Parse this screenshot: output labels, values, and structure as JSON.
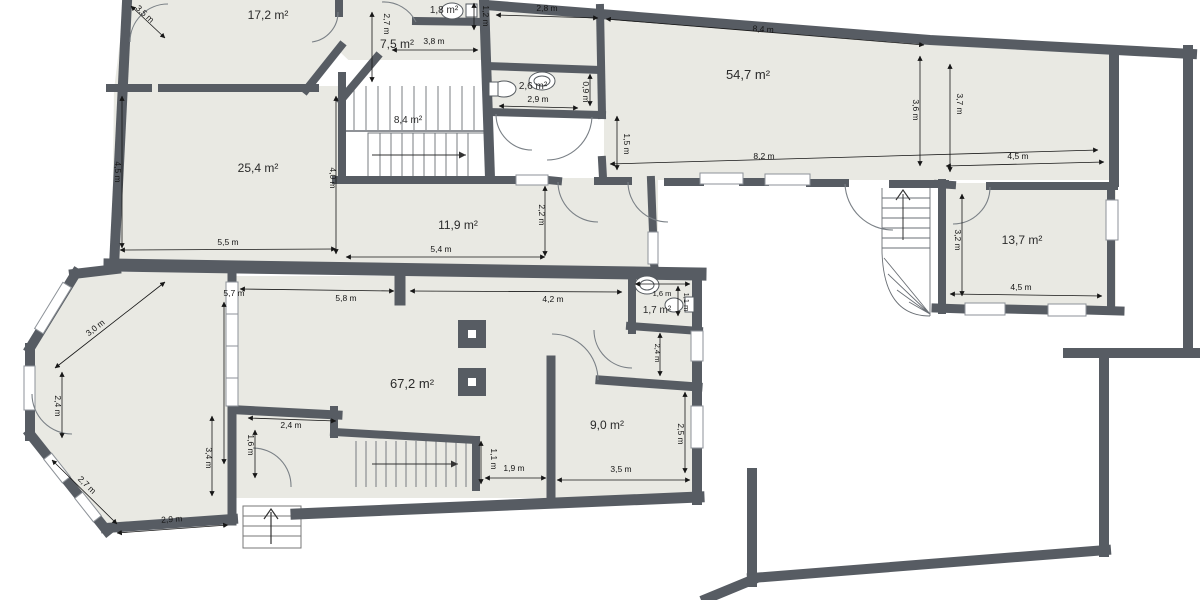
{
  "floorplan": {
    "colors": {
      "wall": "#575c63",
      "room_fill": "#e9e9e3",
      "background": "#ffffff",
      "dim": "#1a1a1a",
      "door": "#7a8086",
      "stair": "#6a6f75"
    },
    "rooms": {
      "r172": "17,2 m²",
      "r18": "1,8 m²",
      "r75": "7,5 m²",
      "r26": "2,6 m²",
      "r547": "54,7 m²",
      "r84": "8,4 m²",
      "r254": "25,4 m²",
      "r119": "11,9 m²",
      "r137": "13,7 m²",
      "r672": "67,2 m²",
      "r17": "1,7 m²",
      "r90": "9,0 m²"
    },
    "dims": {
      "tl_door_35": "3,5 m",
      "hall_h_27": "2,7 m",
      "hall_w_38": "3,8 m",
      "wc1_12": "1,2 m",
      "top_28": "2,8 m",
      "top_84": "8,4 m",
      "wc2_w_29": "2,9 m",
      "wc2_h_09": "0,9 m",
      "big_left_15": "1,5 m",
      "big_bottom_82": "8,2 m",
      "right_36": "3,6 m",
      "right_37": "3,7 m",
      "right_top_45": "4,5 m",
      "r137_h_32": "3,2 m",
      "r137_w_45": "4,5 m",
      "left_45": "4,5 m",
      "mid_40": "4,0 m",
      "bottom_55": "5,5 m",
      "bottom_54": "5,4 m",
      "r119_h_22": "2,2 m",
      "part_57": "5,7 m",
      "top67_58": "5,8 m",
      "top67_42": "4,2 m",
      "bay_30": "3,0 m",
      "bay_24": "2,4 m",
      "bay_27": "2,7 m",
      "bay_29": "2,9 m",
      "bay_34": "3,4 m",
      "vest_24": "2,4 m",
      "vest_16": "1,6 m",
      "stair_11": "1,1 m",
      "stair_19": "1,9 m",
      "r90_35": "3,5 m",
      "r90_25": "2,5 m",
      "bath_16": "1,6 m",
      "bath_11": "1,1 m",
      "bath_24": "2,4 m"
    },
    "fixtures": [
      "toilet-icon",
      "sink-icon",
      "column",
      "staircase-main",
      "staircase-curved",
      "staircase-lower",
      "entrance-steps",
      "door-arc",
      "window"
    ]
  }
}
